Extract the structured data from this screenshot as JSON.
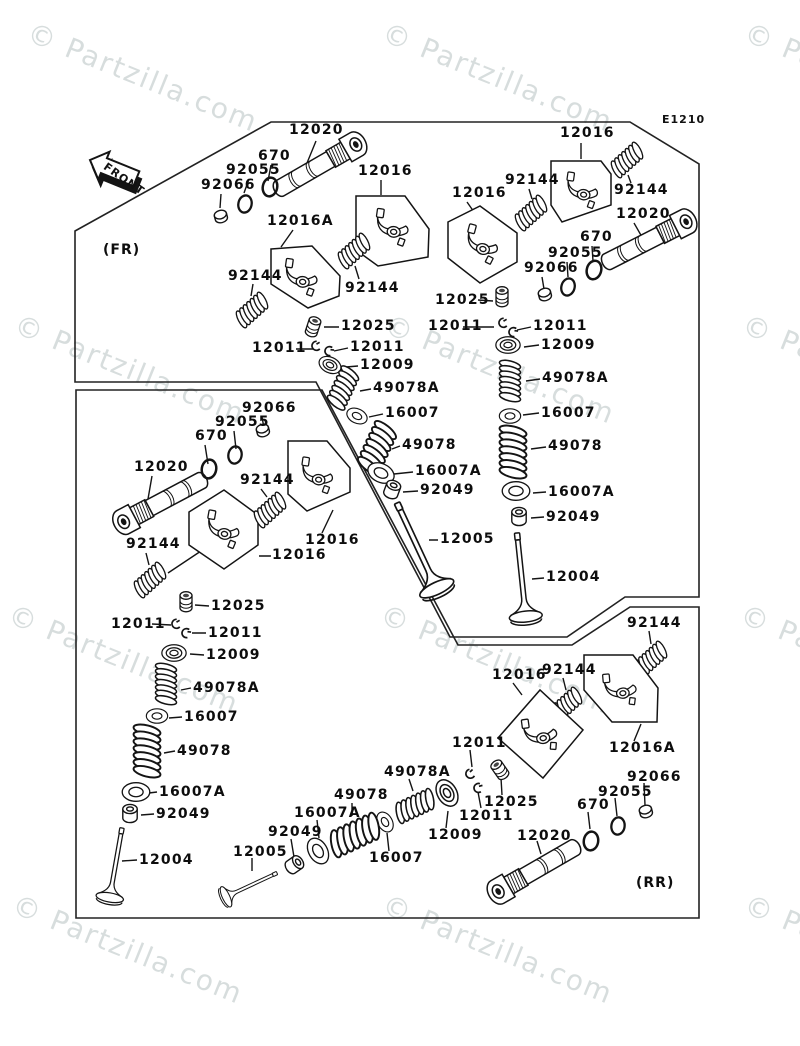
{
  "meta": {
    "code": "E1210",
    "front_label": "FRONT",
    "fr_label": "(FR)",
    "rr_label": "(RR)"
  },
  "watermark": {
    "text": "© Partzilla.com",
    "color": "rgba(130,150,150,0.32)",
    "positions": [
      {
        "x": 35,
        "y": 16
      },
      {
        "x": 390,
        "y": 16
      },
      {
        "x": 752,
        "y": 16
      },
      {
        "x": 22,
        "y": 308
      },
      {
        "x": 392,
        "y": 308
      },
      {
        "x": 750,
        "y": 308
      },
      {
        "x": 16,
        "y": 598
      },
      {
        "x": 388,
        "y": 598
      },
      {
        "x": 748,
        "y": 598
      },
      {
        "x": 20,
        "y": 888
      },
      {
        "x": 390,
        "y": 888
      },
      {
        "x": 752,
        "y": 888
      }
    ]
  },
  "part_numbers": [
    "670",
    "12004",
    "12005",
    "12009",
    "12011",
    "12016",
    "12016A",
    "12020",
    "12025",
    "16007",
    "16007A",
    "49078",
    "49078A",
    "92049",
    "92055",
    "92066",
    "92144"
  ],
  "labels": [
    {
      "t": "12020",
      "x": 289,
      "y": 123
    },
    {
      "t": "670",
      "x": 258,
      "y": 149
    },
    {
      "t": "92055",
      "x": 226,
      "y": 163
    },
    {
      "t": "92066",
      "x": 201,
      "y": 178
    },
    {
      "t": "12016",
      "x": 358,
      "y": 164
    },
    {
      "t": "12016A",
      "x": 267,
      "y": 214
    },
    {
      "t": "92144",
      "x": 228,
      "y": 269
    },
    {
      "t": "92144",
      "x": 345,
      "y": 281
    },
    {
      "t": "12025",
      "x": 341,
      "y": 319
    },
    {
      "t": "12011",
      "x": 252,
      "y": 341
    },
    {
      "t": "12011",
      "x": 350,
      "y": 340
    },
    {
      "t": "12009",
      "x": 360,
      "y": 358
    },
    {
      "t": "49078A",
      "x": 373,
      "y": 381
    },
    {
      "t": "16007",
      "x": 385,
      "y": 406
    },
    {
      "t": "49078",
      "x": 402,
      "y": 438
    },
    {
      "t": "16007A",
      "x": 415,
      "y": 464
    },
    {
      "t": "92049",
      "x": 420,
      "y": 483
    },
    {
      "t": "12005",
      "x": 440,
      "y": 532
    },
    {
      "t": "12004",
      "x": 546,
      "y": 570
    },
    {
      "t": "12016",
      "x": 560,
      "y": 126
    },
    {
      "t": "92144",
      "x": 505,
      "y": 173
    },
    {
      "t": "92144",
      "x": 614,
      "y": 183
    },
    {
      "t": "12016",
      "x": 452,
      "y": 186
    },
    {
      "t": "12020",
      "x": 616,
      "y": 207
    },
    {
      "t": "670",
      "x": 580,
      "y": 230
    },
    {
      "t": "92055",
      "x": 548,
      "y": 246
    },
    {
      "t": "92066",
      "x": 524,
      "y": 261
    },
    {
      "t": "12025",
      "x": 435,
      "y": 293
    },
    {
      "t": "12011",
      "x": 428,
      "y": 319
    },
    {
      "t": "12011",
      "x": 533,
      "y": 319
    },
    {
      "t": "12009",
      "x": 541,
      "y": 338
    },
    {
      "t": "49078A",
      "x": 542,
      "y": 371
    },
    {
      "t": "16007",
      "x": 541,
      "y": 406
    },
    {
      "t": "49078",
      "x": 548,
      "y": 439
    },
    {
      "t": "16007A",
      "x": 548,
      "y": 485
    },
    {
      "t": "92049",
      "x": 546,
      "y": 510
    },
    {
      "t": "92066",
      "x": 242,
      "y": 401
    },
    {
      "t": "92055",
      "x": 215,
      "y": 415
    },
    {
      "t": "670",
      "x": 195,
      "y": 429
    },
    {
      "t": "12020",
      "x": 134,
      "y": 460
    },
    {
      "t": "92144",
      "x": 240,
      "y": 473
    },
    {
      "t": "12016",
      "x": 305,
      "y": 533
    },
    {
      "t": "12016",
      "x": 272,
      "y": 548
    },
    {
      "t": "92144",
      "x": 126,
      "y": 537
    },
    {
      "t": "12025",
      "x": 211,
      "y": 599
    },
    {
      "t": "12011",
      "x": 111,
      "y": 617
    },
    {
      "t": "12011",
      "x": 208,
      "y": 626
    },
    {
      "t": "12009",
      "x": 206,
      "y": 648
    },
    {
      "t": "49078A",
      "x": 193,
      "y": 681
    },
    {
      "t": "16007",
      "x": 184,
      "y": 710
    },
    {
      "t": "49078",
      "x": 177,
      "y": 744
    },
    {
      "t": "16007A",
      "x": 159,
      "y": 785
    },
    {
      "t": "92049",
      "x": 156,
      "y": 807
    },
    {
      "t": "12004",
      "x": 139,
      "y": 853
    },
    {
      "t": "12005",
      "x": 233,
      "y": 845
    },
    {
      "t": "92144",
      "x": 627,
      "y": 616
    },
    {
      "t": "12016",
      "x": 492,
      "y": 668
    },
    {
      "t": "92144",
      "x": 542,
      "y": 663
    },
    {
      "t": "12016A",
      "x": 609,
      "y": 741
    },
    {
      "t": "12011",
      "x": 452,
      "y": 736
    },
    {
      "t": "49078A",
      "x": 384,
      "y": 765
    },
    {
      "t": "49078",
      "x": 334,
      "y": 788
    },
    {
      "t": "16007A",
      "x": 294,
      "y": 806
    },
    {
      "t": "92049",
      "x": 268,
      "y": 825
    },
    {
      "t": "16007",
      "x": 369,
      "y": 851
    },
    {
      "t": "12009",
      "x": 428,
      "y": 828
    },
    {
      "t": "12011",
      "x": 459,
      "y": 809
    },
    {
      "t": "12025",
      "x": 484,
      "y": 795
    },
    {
      "t": "12020",
      "x": 517,
      "y": 829
    },
    {
      "t": "670",
      "x": 577,
      "y": 798
    },
    {
      "t": "92055",
      "x": 598,
      "y": 785
    },
    {
      "t": "92066",
      "x": 627,
      "y": 770
    }
  ]
}
